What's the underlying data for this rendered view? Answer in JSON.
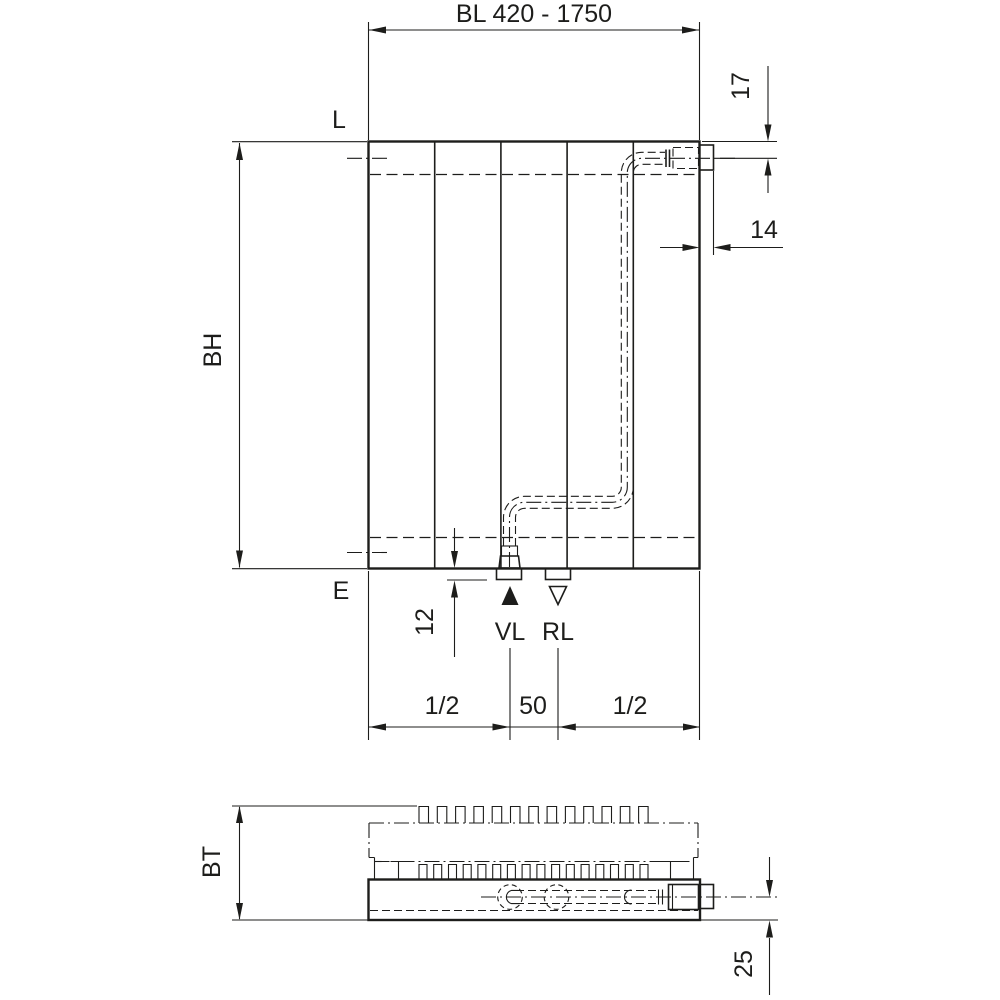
{
  "drawing": {
    "front_view": {
      "connection_labels": {
        "top": "L",
        "bottom": "E",
        "supply": "VL",
        "return": "RL"
      },
      "dimensions": {
        "build_length": "BL 420 - 1750",
        "build_height": "BH",
        "top_connection_offset": "17",
        "nipple_width": "14",
        "bottom_connection_offset": "12",
        "left_half": "1/2",
        "center_spacing": "50",
        "right_half": "1/2"
      }
    },
    "bottom_view": {
      "dimensions": {
        "build_depth": "BT",
        "connection_center_offset": "25"
      }
    },
    "colors": {
      "line": "#1d1d1b",
      "background": "#ffffff"
    }
  }
}
